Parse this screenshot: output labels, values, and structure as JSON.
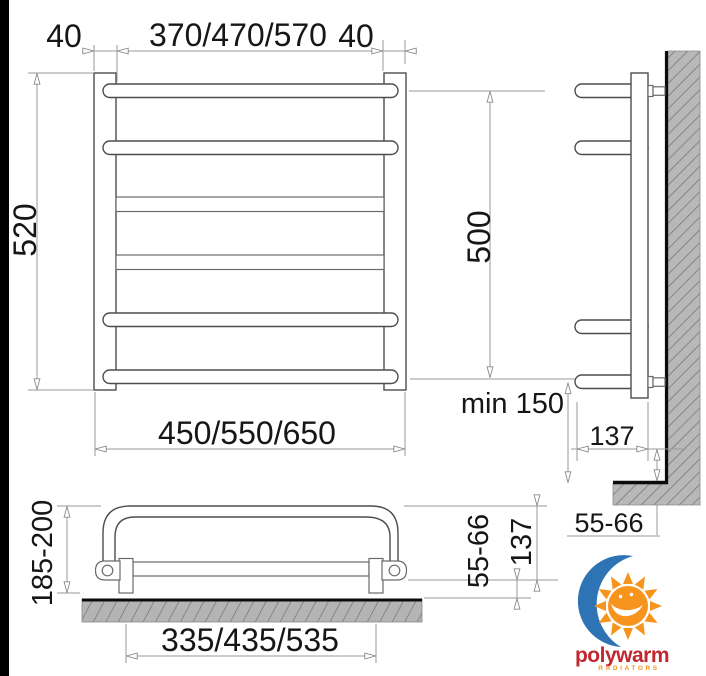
{
  "front_view": {
    "dim_top_left": "40",
    "dim_top_width": "370/470/570",
    "dim_top_right": "40",
    "dim_height": "520",
    "dim_width": "450/550/650"
  },
  "side_view": {
    "dim_height": "500",
    "dim_min_floor": "min 150",
    "dim_depth": "137",
    "dim_step": "55-66"
  },
  "plan_view": {
    "dim_depth": "185-200",
    "dim_offset": "55-66",
    "dim_inner_depth": "137",
    "dim_mount_width": "335/435/535"
  },
  "logo": {
    "brand": "polywarm",
    "sub": "RADIATORS",
    "colors": {
      "blue": "#2e74b5",
      "orange": "#f7941d",
      "red": "#c1272d"
    }
  },
  "style": {
    "object_line": "#4d4d4d",
    "dimension_line": "#9a9a9a",
    "wall_fill": "#b8b8b8",
    "wall_hatch": "#6f6f6f",
    "edge_bar": "#000000"
  }
}
